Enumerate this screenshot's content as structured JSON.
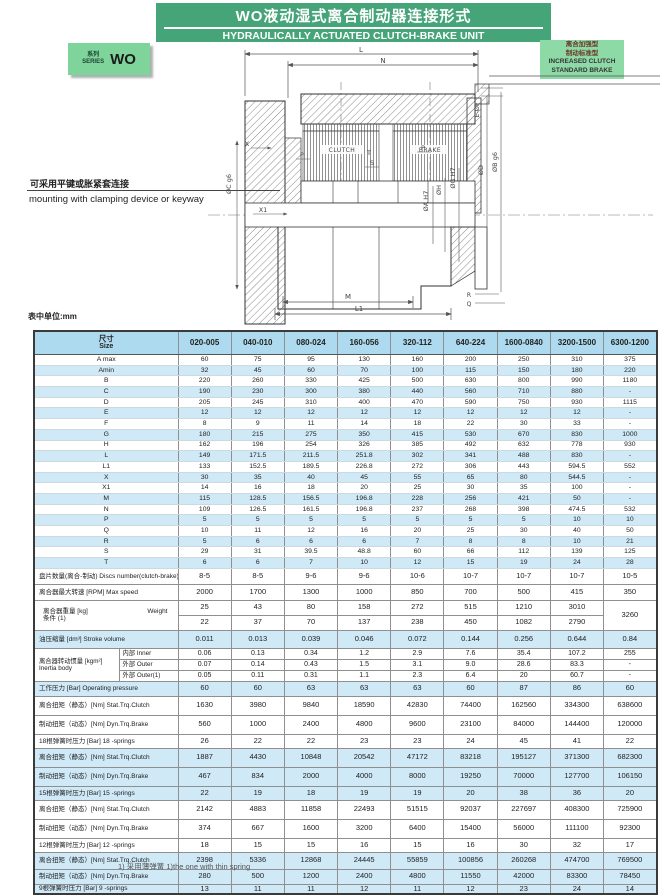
{
  "banner": {
    "title_zh": "WO液动湿式离合制动器连接形式",
    "title_en": "HYDRAULICALLY ACTUATED CLUTCH-BRAKE UNIT",
    "bg": "#45a478"
  },
  "series_badge": {
    "label_zh": "系列",
    "label_en": "SERIES",
    "code": "WO",
    "bg": "#7fd49c"
  },
  "variant_note": {
    "lines_zh": [
      "离合加强型",
      "制动标准型"
    ],
    "lines_en": [
      "INCREASED CLUTCH",
      "STANDARD BRAKE"
    ],
    "bg": "#8edaa6"
  },
  "mounting_note": {
    "zh": "可采用平键或胀紧套连接",
    "en": "mounting with clamping device or keyway"
  },
  "units_note": "表中单位:mm",
  "drawing": {
    "dim_l": "L",
    "dim_n": "N",
    "dim_m": "M",
    "dim_l1": "L1",
    "clutch_label": "CLUTCH",
    "brake_label": "BRAKE",
    "x_label": "X",
    "x1_label": "X1",
    "p_label": "P",
    "p2_label": "P",
    "q_label": "Q",
    "r_label": "R",
    "s_label": "S",
    "t_label": "T",
    "dia_c": "ØC g6",
    "dia_a": "ØA H7",
    "dia_h": "ØH",
    "dia_g": "ØG H7",
    "dia_d": "ØD",
    "dia_b": "ØB g6",
    "bolt_label": "E-ØF"
  },
  "colors": {
    "header_blue": "#addaee",
    "row_blue": "#cfe9f7",
    "banner_green": "#45a478",
    "badge_green": "#7fd49c",
    "note_green": "#8edaa6"
  },
  "table": {
    "size_label_zh": "尺寸",
    "size_label_en": "Size",
    "columns": [
      "020-005",
      "040-010",
      "080-024",
      "160-056",
      "320-112",
      "640-224",
      "1600-0840",
      "3200-1500",
      "6300-1200"
    ],
    "rows": [
      {
        "kind": "dim",
        "label": "A max",
        "v": [
          "60",
          "75",
          "95",
          "130",
          "160",
          "200",
          "250",
          "310",
          "375"
        ],
        "bg": "w"
      },
      {
        "kind": "dim",
        "label": "Amin",
        "v": [
          "32",
          "45",
          "60",
          "70",
          "100",
          "115",
          "150",
          "180",
          "220"
        ],
        "bg": "b"
      },
      {
        "kind": "dim",
        "label": "B",
        "v": [
          "220",
          "260",
          "330",
          "425",
          "500",
          "630",
          "800",
          "990",
          "1180"
        ],
        "bg": "w"
      },
      {
        "kind": "dim",
        "label": "C",
        "v": [
          "190",
          "230",
          "300",
          "380",
          "440",
          "560",
          "710",
          "880",
          "-"
        ],
        "bg": "b"
      },
      {
        "kind": "dim",
        "label": "D",
        "v": [
          "205",
          "245",
          "310",
          "400",
          "470",
          "590",
          "750",
          "930",
          "1115"
        ],
        "bg": "w"
      },
      {
        "kind": "dim",
        "label": "E",
        "v": [
          "12",
          "12",
          "12",
          "12",
          "12",
          "12",
          "12",
          "12",
          "-"
        ],
        "bg": "b"
      },
      {
        "kind": "dim",
        "label": "F",
        "v": [
          "8",
          "9",
          "11",
          "14",
          "18",
          "22",
          "30",
          "33",
          "-"
        ],
        "bg": "w"
      },
      {
        "kind": "dim",
        "label": "G",
        "v": [
          "180",
          "215",
          "275",
          "350",
          "415",
          "530",
          "670",
          "830",
          "1000"
        ],
        "bg": "b"
      },
      {
        "kind": "dim",
        "label": "H",
        "v": [
          "162",
          "196",
          "254",
          "326",
          "385",
          "492",
          "632",
          "778",
          "930"
        ],
        "bg": "w"
      },
      {
        "kind": "dim",
        "label": "L",
        "v": [
          "149",
          "171.5",
          "211.5",
          "251.8",
          "302",
          "341",
          "488",
          "830",
          "-"
        ],
        "bg": "b"
      },
      {
        "kind": "dim",
        "label": "L1",
        "v": [
          "133",
          "152.5",
          "189.5",
          "226.8",
          "272",
          "306",
          "443",
          "594.5",
          "552"
        ],
        "bg": "w"
      },
      {
        "kind": "dim",
        "label": "X",
        "v": [
          "30",
          "35",
          "40",
          "45",
          "55",
          "65",
          "80",
          "544.5",
          "-"
        ],
        "bg": "b"
      },
      {
        "kind": "dim",
        "label": "X1",
        "v": [
          "14",
          "16",
          "18",
          "20",
          "25",
          "30",
          "35",
          "100",
          "-"
        ],
        "bg": "w"
      },
      {
        "kind": "dim",
        "label": "M",
        "v": [
          "115",
          "128.5",
          "156.5",
          "196.8",
          "228",
          "256",
          "421",
          "50",
          "-"
        ],
        "bg": "b"
      },
      {
        "kind": "dim",
        "label": "N",
        "v": [
          "109",
          "126.5",
          "161.5",
          "196.8",
          "237",
          "268",
          "398",
          "474.5",
          "532"
        ],
        "bg": "w"
      },
      {
        "kind": "dim",
        "label": "P",
        "v": [
          "5",
          "5",
          "5",
          "5",
          "5",
          "5",
          "5",
          "10",
          "10"
        ],
        "bg": "b"
      },
      {
        "kind": "dim",
        "label": "Q",
        "v": [
          "10",
          "11",
          "12",
          "16",
          "20",
          "25",
          "30",
          "40",
          "50"
        ],
        "bg": "w"
      },
      {
        "kind": "dim",
        "label": "R",
        "v": [
          "5",
          "6",
          "6",
          "6",
          "7",
          "8",
          "8",
          "10",
          "21"
        ],
        "bg": "b"
      },
      {
        "kind": "dim",
        "label": "S",
        "v": [
          "29",
          "31",
          "39.5",
          "48.8",
          "60",
          "66",
          "112",
          "139",
          "125"
        ],
        "bg": "w"
      },
      {
        "kind": "dim",
        "label": "T",
        "v": [
          "6",
          "6",
          "7",
          "10",
          "12",
          "15",
          "19",
          "24",
          "28"
        ],
        "bg": "b"
      },
      {
        "kind": "single",
        "label": "盘片数量(离合-制动) Discs number(clutch-brake)",
        "v": [
          "8-5",
          "8-5",
          "9-6",
          "9-6",
          "10-6",
          "10-7",
          "10-7",
          "10-7",
          "10-5"
        ],
        "bg": "w",
        "h": 16
      },
      {
        "kind": "single",
        "label": "离合器最大转速 [RPM] Max speed",
        "v": [
          "2000",
          "1700",
          "1300",
          "1000",
          "850",
          "700",
          "500",
          "415",
          "350"
        ],
        "bg": "w",
        "h": 16
      },
      {
        "kind": "weight",
        "label_line1_zh": "离合器重量 [kg]",
        "label_line1_en": "Weight",
        "label_line2": "条件 (1)",
        "v1": [
          "25",
          "43",
          "80",
          "158",
          "272",
          "515",
          "1210",
          "3010"
        ],
        "v2": [
          "22",
          "37",
          "70",
          "137",
          "238",
          "450",
          "1082",
          "2790"
        ],
        "vlast": "3260",
        "bg": "w",
        "h": 15
      },
      {
        "kind": "single",
        "label": "油压缩量 [dm³] Stroke volume",
        "v": [
          "0.011",
          "0.013",
          "0.039",
          "0.046",
          "0.072",
          "0.144",
          "0.256",
          "0.644",
          "0.84"
        ],
        "bg": "b",
        "h": 18
      },
      {
        "kind": "inertia",
        "label_zh": "离合器转动惯量 [kgm²]",
        "label_en": "Inertia body",
        "subs": [
          "内部 Inner",
          "外部 Outer",
          "外部 Outer(1)"
        ],
        "rows": [
          [
            "0.06",
            "0.13",
            "0.34",
            "1.2",
            "2.9",
            "7.6",
            "35.4",
            "107.2",
            "255"
          ],
          [
            "0.07",
            "0.14",
            "0.43",
            "1.5",
            "3.1",
            "9.0",
            "28.6",
            "83.3",
            "-"
          ],
          [
            "0.05",
            "0.11",
            "0.31",
            "1.1",
            "2.3",
            "6.4",
            "20",
            "60.7",
            "-"
          ]
        ],
        "bg": "w",
        "h": 10
      },
      {
        "kind": "single",
        "label": "工作压力 [Bar] Operating pressure",
        "v": [
          "60",
          "60",
          "63",
          "63",
          "63",
          "60",
          "87",
          "86",
          "60"
        ],
        "bg": "b",
        "h": 15
      },
      {
        "kind": "single",
        "label": "离合扭矩（静态）[Nm] Stat.Trq.Clutch",
        "v": [
          "1630",
          "3980",
          "9840",
          "18590",
          "42830",
          "74400",
          "162560",
          "334300",
          "638600"
        ],
        "bg": "w",
        "h": 19
      },
      {
        "kind": "single",
        "label": "制动扭矩（动态）[Nm] Dyn.Trq.Brake",
        "v": [
          "560",
          "1000",
          "2400",
          "4800",
          "9600",
          "23100",
          "84000",
          "144400",
          "120000"
        ],
        "bg": "w",
        "h": 19
      },
      {
        "kind": "single",
        "label": "18根弹簧时压力 [Bar] 18 -springs",
        "v": [
          "26",
          "22",
          "22",
          "23",
          "23",
          "24",
          "45",
          "41",
          "22"
        ],
        "bg": "w",
        "h": 14
      },
      {
        "kind": "single",
        "label": "离合扭矩（静态）[Nm] Stat.Trq.Clutch",
        "v": [
          "1887",
          "4430",
          "10848",
          "20542",
          "47172",
          "83218",
          "195127",
          "371300",
          "682300"
        ],
        "bg": "b",
        "h": 19
      },
      {
        "kind": "single",
        "label": "制动扭矩（动态）[Nm] Dyn.Trq.Brake",
        "v": [
          "467",
          "834",
          "2000",
          "4000",
          "8000",
          "19250",
          "70000",
          "127700",
          "106150"
        ],
        "bg": "b",
        "h": 19
      },
      {
        "kind": "single",
        "label": "15根弹簧时压力 [Bar] 15 -springs",
        "v": [
          "22",
          "19",
          "18",
          "19",
          "19",
          "20",
          "38",
          "36",
          "20"
        ],
        "bg": "b",
        "h": 14
      },
      {
        "kind": "single",
        "label": "离合扭矩（静态）[Nm] Stat.Trq.Clutch",
        "v": [
          "2142",
          "4883",
          "11858",
          "22493",
          "51515",
          "92037",
          "227697",
          "408300",
          "725900"
        ],
        "bg": "w",
        "h": 19
      },
      {
        "kind": "single",
        "label": "制动扭矩（动态）[Nm] Dyn.Trq.Brake",
        "v": [
          "374",
          "667",
          "1600",
          "3200",
          "6400",
          "15400",
          "56000",
          "111100",
          "92300"
        ],
        "bg": "w",
        "h": 19
      },
      {
        "kind": "single",
        "label": "12根弹簧时压力 [Bar] 12 -springs",
        "v": [
          "18",
          "15",
          "15",
          "16",
          "15",
          "16",
          "30",
          "32",
          "17"
        ],
        "bg": "w",
        "h": 14
      },
      {
        "kind": "single",
        "label": "离合扭矩（静态）[Nm] Stat.Trq.Clutch",
        "v": [
          "2398",
          "5336",
          "12868",
          "24445",
          "55859",
          "100856",
          "260268",
          "474700",
          "769500"
        ],
        "bg": "b",
        "h": 17
      },
      {
        "kind": "single",
        "label": "制动扭矩（动态）[Nm] Dyn.Trq.Brake",
        "v": [
          "280",
          "500",
          "1200",
          "2400",
          "4800",
          "11550",
          "42000",
          "83300",
          "78450"
        ],
        "bg": "b",
        "h": 15
      },
      {
        "kind": "single",
        "label": "9根弹簧时压力 [Bar] 9 -springs",
        "v": [
          "13",
          "11",
          "11",
          "12",
          "11",
          "12",
          "23",
          "24",
          "14"
        ],
        "bg": "b",
        "h": 10
      }
    ]
  },
  "footnote": "1) 采用薄弹簧 1)the one with thin spring"
}
